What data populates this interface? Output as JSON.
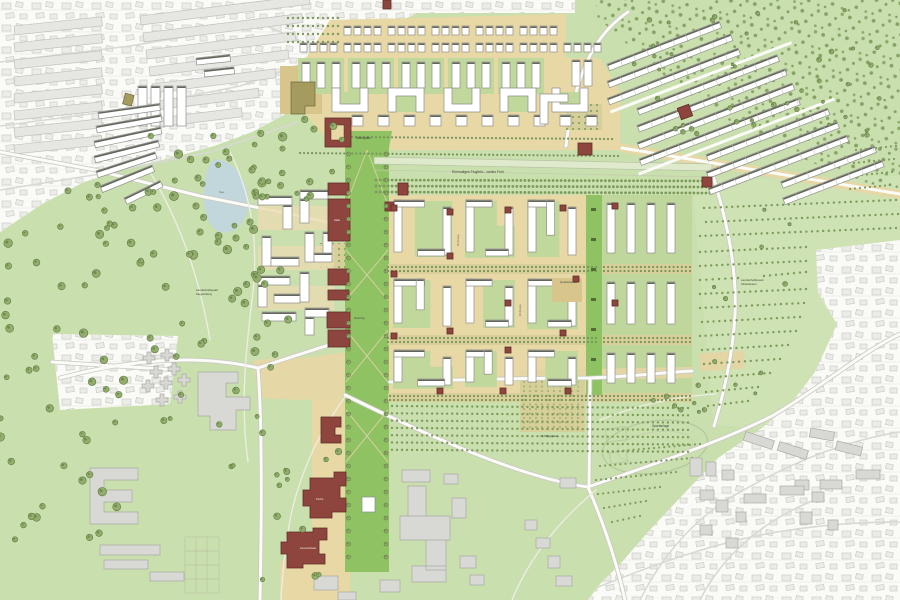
{
  "map": {
    "type": "urban-masterplan-site-plan",
    "palette": {
      "existing_city_white": "#fafaf7",
      "existing_building_gray": "#e9e9e6",
      "park_green": "#cadfae",
      "field_green": "#d2e3ba",
      "axis_green": "#8ec263",
      "court_green": "#c1d89d",
      "street_beige": "#e7d8a6",
      "plaza_tan": "#d8c58c",
      "hedge_tan": "#d8cf9a",
      "heritage_red": "#8d453e",
      "campus_gray": "#d8d8d5",
      "khaki_building": "#a59b5e",
      "lake_blue": "#c2d7db",
      "tree_olive": "#93ad6c",
      "forest_dot": "#7d9b5c",
      "road_white": "#fbfbf7",
      "label_dark": "#3f4238",
      "label_light": "#f2efe8",
      "label_mid": "#6b7162"
    },
    "labels": [
      {
        "id": "flugfeld",
        "text": "Ehemaliges Flugfeld – weites Feld",
        "x": 452,
        "y": 173,
        "size": 3.4,
        "color": "dark",
        "anchor": "start"
      },
      {
        "id": "marktplatz",
        "text": "Marktplatz",
        "x": 356,
        "y": 139,
        "size": 3.2,
        "color": "dark",
        "anchor": "start"
      },
      {
        "id": "landschaftspark-1",
        "text": "Landschaftspark",
        "x": 196,
        "y": 291,
        "size": 3,
        "color": "dark",
        "anchor": "start"
      },
      {
        "id": "landschaftspark-2",
        "text": "Siegelsberg",
        "x": 196,
        "y": 295,
        "size": 3,
        "color": "dark",
        "anchor": "start"
      },
      {
        "id": "landschaftsraum-1",
        "text": "Landschaftsraum",
        "x": 741,
        "y": 281,
        "size": 3,
        "color": "dark",
        "anchor": "start"
      },
      {
        "id": "landschaftsraum-2",
        "text": "Obstwiesen",
        "x": 741,
        "y": 285,
        "size": 3,
        "color": "dark",
        "anchor": "start"
      },
      {
        "id": "quartiersplatz",
        "text": "Quartiersplatz",
        "x": 560,
        "y": 283,
        "size": 2.8,
        "color": "dark",
        "anchor": "start"
      },
      {
        "id": "sportanlage",
        "text": "Sportanlage",
        "x": 652,
        "y": 427,
        "size": 3.2,
        "color": "dark",
        "anchor": "start"
      },
      {
        "id": "see",
        "text": "See",
        "x": 219,
        "y": 193,
        "size": 3,
        "color": "mid",
        "anchor": "start"
      },
      {
        "id": "gruenzug",
        "text": "Grünzug",
        "x": 354,
        "y": 319,
        "size": 2.8,
        "color": "dark",
        "anchor": "start"
      },
      {
        "id": "obstgarten",
        "text": "Im Obstgarten",
        "x": 540,
        "y": 437,
        "size": 2.8,
        "color": "dark",
        "anchor": "start"
      },
      {
        "id": "halle",
        "text": "Halle",
        "x": 334,
        "y": 221,
        "size": 2.6,
        "color": "light",
        "anchor": "start"
      },
      {
        "id": "kirche",
        "text": "Kirche",
        "x": 316,
        "y": 500,
        "size": 2.6,
        "color": "light",
        "anchor": "start"
      },
      {
        "id": "gemeindehaus",
        "text": "Gemeindehaus",
        "x": 300,
        "y": 549,
        "size": 2.4,
        "color": "light",
        "anchor": "start"
      },
      {
        "id": "wohnweg-1",
        "text": "Wohnweg",
        "x": 459,
        "y": 246,
        "size": 2.6,
        "color": "mid",
        "anchor": "start",
        "rot": -90
      },
      {
        "id": "wohnweg-2",
        "text": "Wohnweg",
        "x": 521,
        "y": 316,
        "size": 2.6,
        "color": "mid",
        "anchor": "start",
        "rot": -90
      }
    ]
  }
}
